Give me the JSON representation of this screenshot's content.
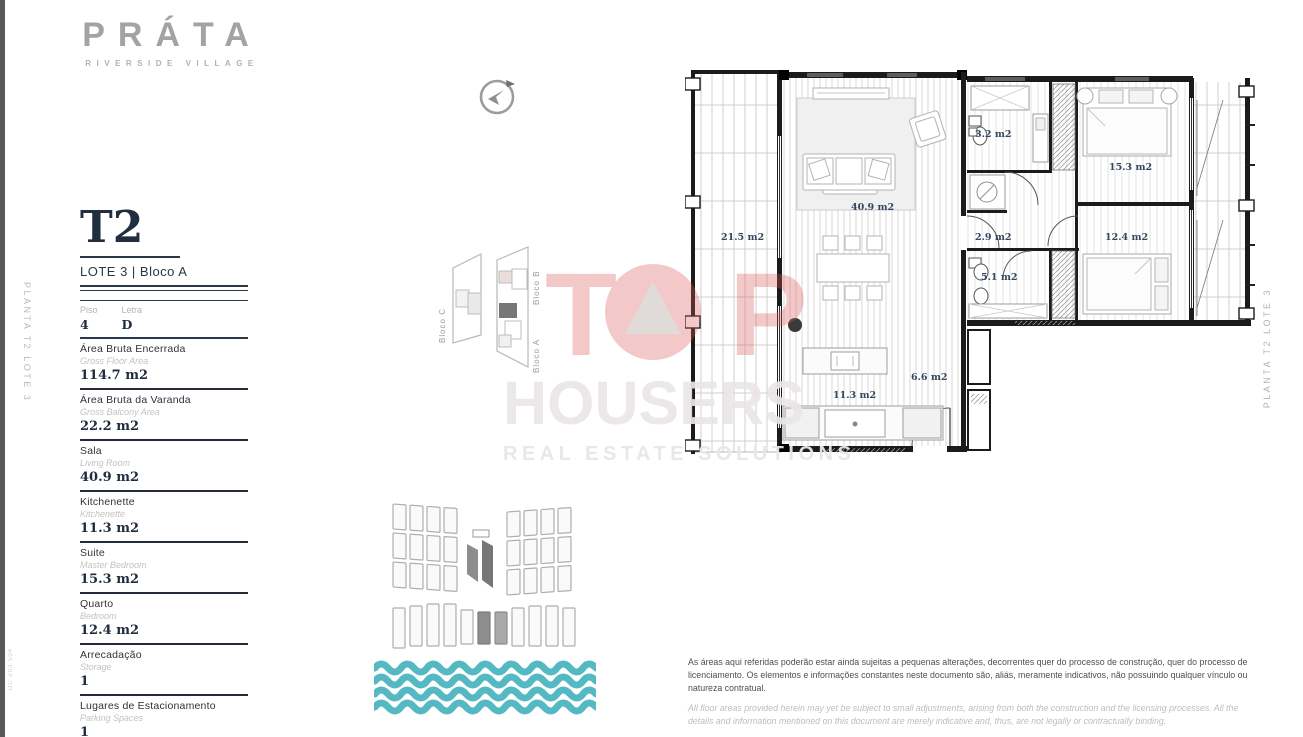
{
  "brand": {
    "logo": "PRÁTA",
    "subtitle": "RIVERSIDE VILLAGE"
  },
  "margins": {
    "left_vertical": "PLANTA T2 LOTE 3",
    "right_vertical": "PLANTA T2 LOTE 3",
    "doc_code": "DC 203 504"
  },
  "unit": {
    "type": "T2",
    "location": "LOTE 3 | Bloco A",
    "floor": {
      "label": "Piso",
      "value": "4"
    },
    "letter": {
      "label": "Letra",
      "value": "D"
    },
    "specs": [
      {
        "pt": "Área Bruta Encerrada",
        "en": "Gross Floor Area",
        "value": "114.7 m2"
      },
      {
        "pt": "Área Bruta da Varanda",
        "en": "Gross Balcony Area",
        "value": "22.2 m2"
      },
      {
        "pt": "Sala",
        "en": "Living Room",
        "value": "40.9 m2"
      },
      {
        "pt": "Kitchenette",
        "en": "Kitchenette",
        "value": "11.3 m2"
      },
      {
        "pt": "Suite",
        "en": "Master Bedroom",
        "value": "15.3 m2"
      },
      {
        "pt": "Quarto",
        "en": "Bedroom",
        "value": "12.4 m2"
      },
      {
        "pt": "Arrecadação",
        "en": "Storage",
        "value": "1"
      },
      {
        "pt": "Lugares de Estacionamento",
        "en": "Parking Spaces",
        "value": "1"
      }
    ]
  },
  "site_plan": {
    "bloco_a": "Bloco A",
    "bloco_b": "Bloco B",
    "bloco_c": "Bloco C"
  },
  "floorplan": {
    "rooms": [
      {
        "name": "balcony",
        "area": "21.5 m2"
      },
      {
        "name": "living-room",
        "area": "40.9 m2"
      },
      {
        "name": "kitchenette",
        "area": "11.3 m2"
      },
      {
        "name": "hall",
        "area": "6.6 m2"
      },
      {
        "name": "bathroom-1",
        "area": "3.2 m2"
      },
      {
        "name": "suite",
        "area": "15.3 m2"
      },
      {
        "name": "hallway",
        "area": "2.9 m2"
      },
      {
        "name": "bathroom-2",
        "area": "5.1 m2"
      },
      {
        "name": "bedroom",
        "area": "12.4 m2"
      }
    ]
  },
  "watermark": {
    "t": "T",
    "p": "P",
    "housers": "HOUSERS",
    "tagline": "REAL ESTATE SOLUTIONS"
  },
  "disclaimer": {
    "pt": "As áreas aqui referidas poderão estar ainda sujeitas a pequenas alterações, decorrentes quer do processo de construção, quer do processo de licenciamento. Os elementos e informações constantes neste documento são, aliás, meramente indicativos, não possuindo qualquer vínculo ou natureza contratual.",
    "en": "All floor areas provided herein may yet be subject to small adjustments, arising from both the construction and the licensing processes. All the details and information mentioned on this document are merely indicative and, thus, are not legally or contractually binding."
  },
  "colors": {
    "navy": "#1f2c3e",
    "logo_gray": "#a3a3a3",
    "watermark_red": "#d95b58",
    "wave_teal": "#55b9c4"
  }
}
